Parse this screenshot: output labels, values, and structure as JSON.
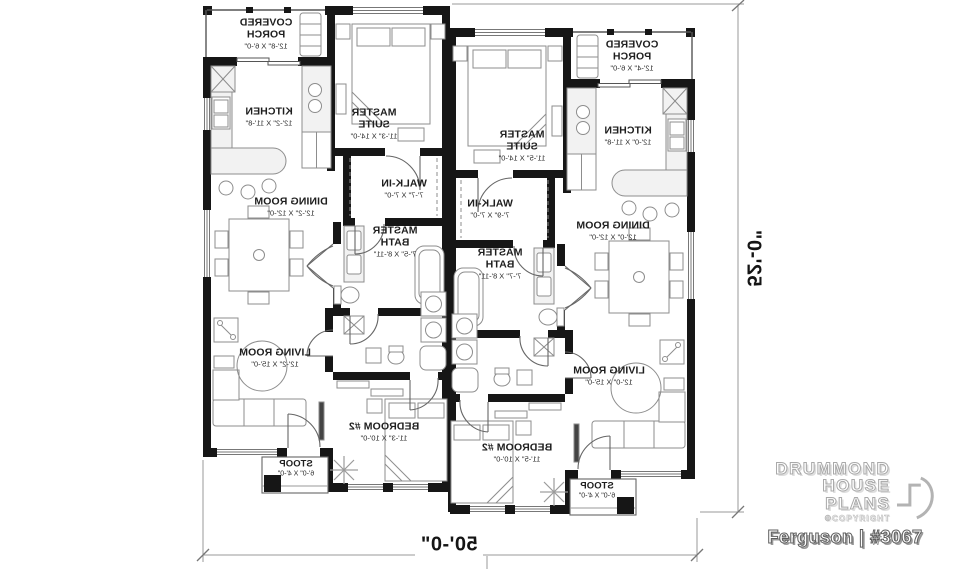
{
  "plan": {
    "left_unit": {
      "porch": {
        "name": "COVERED PORCH",
        "dims": "12'-8\" X 6'-0\""
      },
      "kitchen": {
        "name": "KITCHEN",
        "dims": "12'-2\" X 11'-8\""
      },
      "master_suite": {
        "name": "MASTER SUITE",
        "dims": "11'-3\" X 14'-0\""
      },
      "walk_in": {
        "name": "WALK-IN",
        "dims": "7'-7\" X 7'-0\""
      },
      "dining": {
        "name": "DINING ROOM",
        "dims": "12'-2\" X 12'-0\""
      },
      "master_bath": {
        "name": "MASTER BATH",
        "dims": "7'-5\" X 8'-11\""
      },
      "living": {
        "name": "LIVING ROOM",
        "dims": "12'-2\" X 15'-0\""
      },
      "bedroom2": {
        "name": "BEDROOM #2",
        "dims": "11'-3\" X 10'-0\""
      },
      "stoop": {
        "name": "STOOP",
        "dims": "6'-0\" X 4'-0\""
      }
    },
    "right_unit": {
      "porch": {
        "name": "COVERED PORCH",
        "dims": "12'-4\" X 6'-0\""
      },
      "kitchen": {
        "name": "KITCHEN",
        "dims": "12'-0\" X 11'-8\""
      },
      "master_suite": {
        "name": "MASTER SUITE",
        "dims": "11'-5\" X 14'-0\""
      },
      "walk_in": {
        "name": "WALK-IN",
        "dims": "7'-9\" X 7'-0\""
      },
      "dining": {
        "name": "DINING ROOM",
        "dims": "12'-0\" X 12'-0\""
      },
      "master_bath": {
        "name": "MASTER BATH",
        "dims": "7'-7\" X 8'-11\""
      },
      "living": {
        "name": "LIVING ROOM",
        "dims": "12'-0\" X 15'-0\""
      },
      "bedroom2": {
        "name": "BEDROOM #2",
        "dims": "11'-5\" X 10'-0\""
      },
      "stoop": {
        "name": "STOOP",
        "dims": "6'-0\" X 4'-0\""
      }
    },
    "overall_width": "50'-0\"",
    "overall_height": "52'-0\""
  },
  "branding": {
    "brand_line1": "DRUMMOND",
    "brand_line2": "HOUSE PLANS",
    "copyright": "©COPYRIGHT",
    "plan_name": "Ferguson | #3067"
  },
  "colors": {
    "wall": "#161616",
    "furniture_line": "#8d8d8d",
    "dimension_line": "#999999",
    "text": "#1e1e1e",
    "background": "#ffffff"
  }
}
